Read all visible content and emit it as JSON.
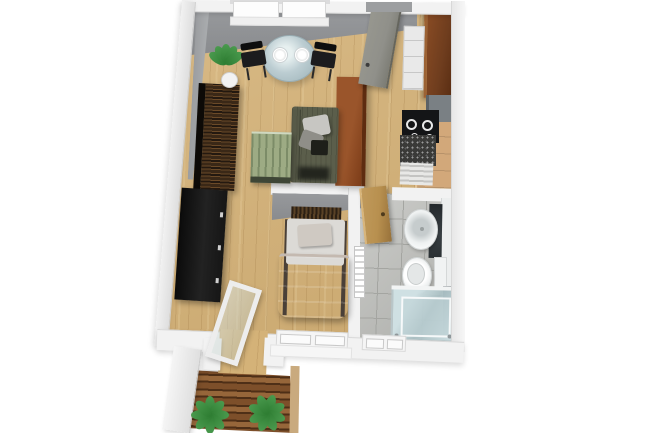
{
  "scene": {
    "label": "3D rendered floor plan of a one-room apartment with balcony, viewed from above",
    "type": "3d-floor-plan",
    "rooms": [
      {
        "name": "living-room",
        "floor": "light-oak-parquet"
      },
      {
        "name": "kitchen",
        "floor": "light-oak-parquet"
      },
      {
        "name": "bedroom",
        "floor": "light-oak-parquet"
      },
      {
        "name": "bathroom",
        "floor": "gray-tile"
      },
      {
        "name": "balcony",
        "floor": "brown-wood-deck"
      }
    ],
    "furniture": {
      "living_room": [
        "potted-plant",
        "round-glass-dining-table",
        "two-white-place-settings",
        "black-dining-chair-left",
        "black-dining-chair-right",
        "zebra-wood-wardrobe",
        "black-tv-lowboard",
        "olive-green-sofa-with-gray-pillows",
        "green-striped-coffee-table",
        "rust-brown-room-divider"
      ],
      "kitchen": [
        "open-entrance-door",
        "tall-brown-cabinet",
        "white-drawer-unit",
        "gray-appliance-block",
        "black-cooktop-with-burners",
        "granite-speckled-counter",
        "beige-base-cabinets",
        "white-vented-cabinet"
      ],
      "bedroom": [
        "single-bed-with-taupe-blanket",
        "slatted-headboard",
        "open-glass-balcony-door",
        "double-casement-window"
      ],
      "bathroom": [
        "wooden-door-ajar",
        "oval-washbasin",
        "dark-mirror-cabinet",
        "white-vanity-strip",
        "toilet-with-cistern",
        "towel-radiator",
        "glass-shower-enclosure",
        "small-window"
      ],
      "balcony": [
        "wood-plank-decking",
        "green-plant-left",
        "green-plant-right"
      ]
    }
  },
  "palette": {
    "wood_floor": "#d4b278",
    "tile_floor": "#b8b9b5",
    "tile_grout": "#a4a5a1",
    "deck_base": "#7d4f2a",
    "deck_dark": "#4e2f17",
    "deck_light": "#96663a",
    "wall_white": "#f2f2f2",
    "wardrobe_dark": "#241910",
    "wardrobe_light": "#6b4a28",
    "tv_black": "#161616",
    "sofa_olive": "#5b5e4b",
    "pillow_light": "#c7c6c2",
    "table_glass": "#bccdd2",
    "chair_black": "#1c1c1e",
    "coffee_top": "#9dab84",
    "coffee_face": "#3e4636",
    "divider_rust": "#9a552b",
    "divider_edge": "#5e2c10",
    "cab_brown": "#6f3d1e",
    "cab_beige": "#d2a87a",
    "counter_granite": "#3a3a38",
    "appliance_gray": "#7a8084",
    "cooktop_black": "#141517",
    "door_gray": "#90908a",
    "door_tan": "#b8904f",
    "bed_blanket": "#a89d94",
    "bed_sheet": "#dcdad6",
    "headboard_dark": "#2c2014",
    "glass_shower": "#cfe0e3",
    "plant_green": "#2e7d32",
    "plant_light": "#4a9a4e",
    "pot_white": "#f2f2f2",
    "porcelain": "#f7f9f9"
  }
}
